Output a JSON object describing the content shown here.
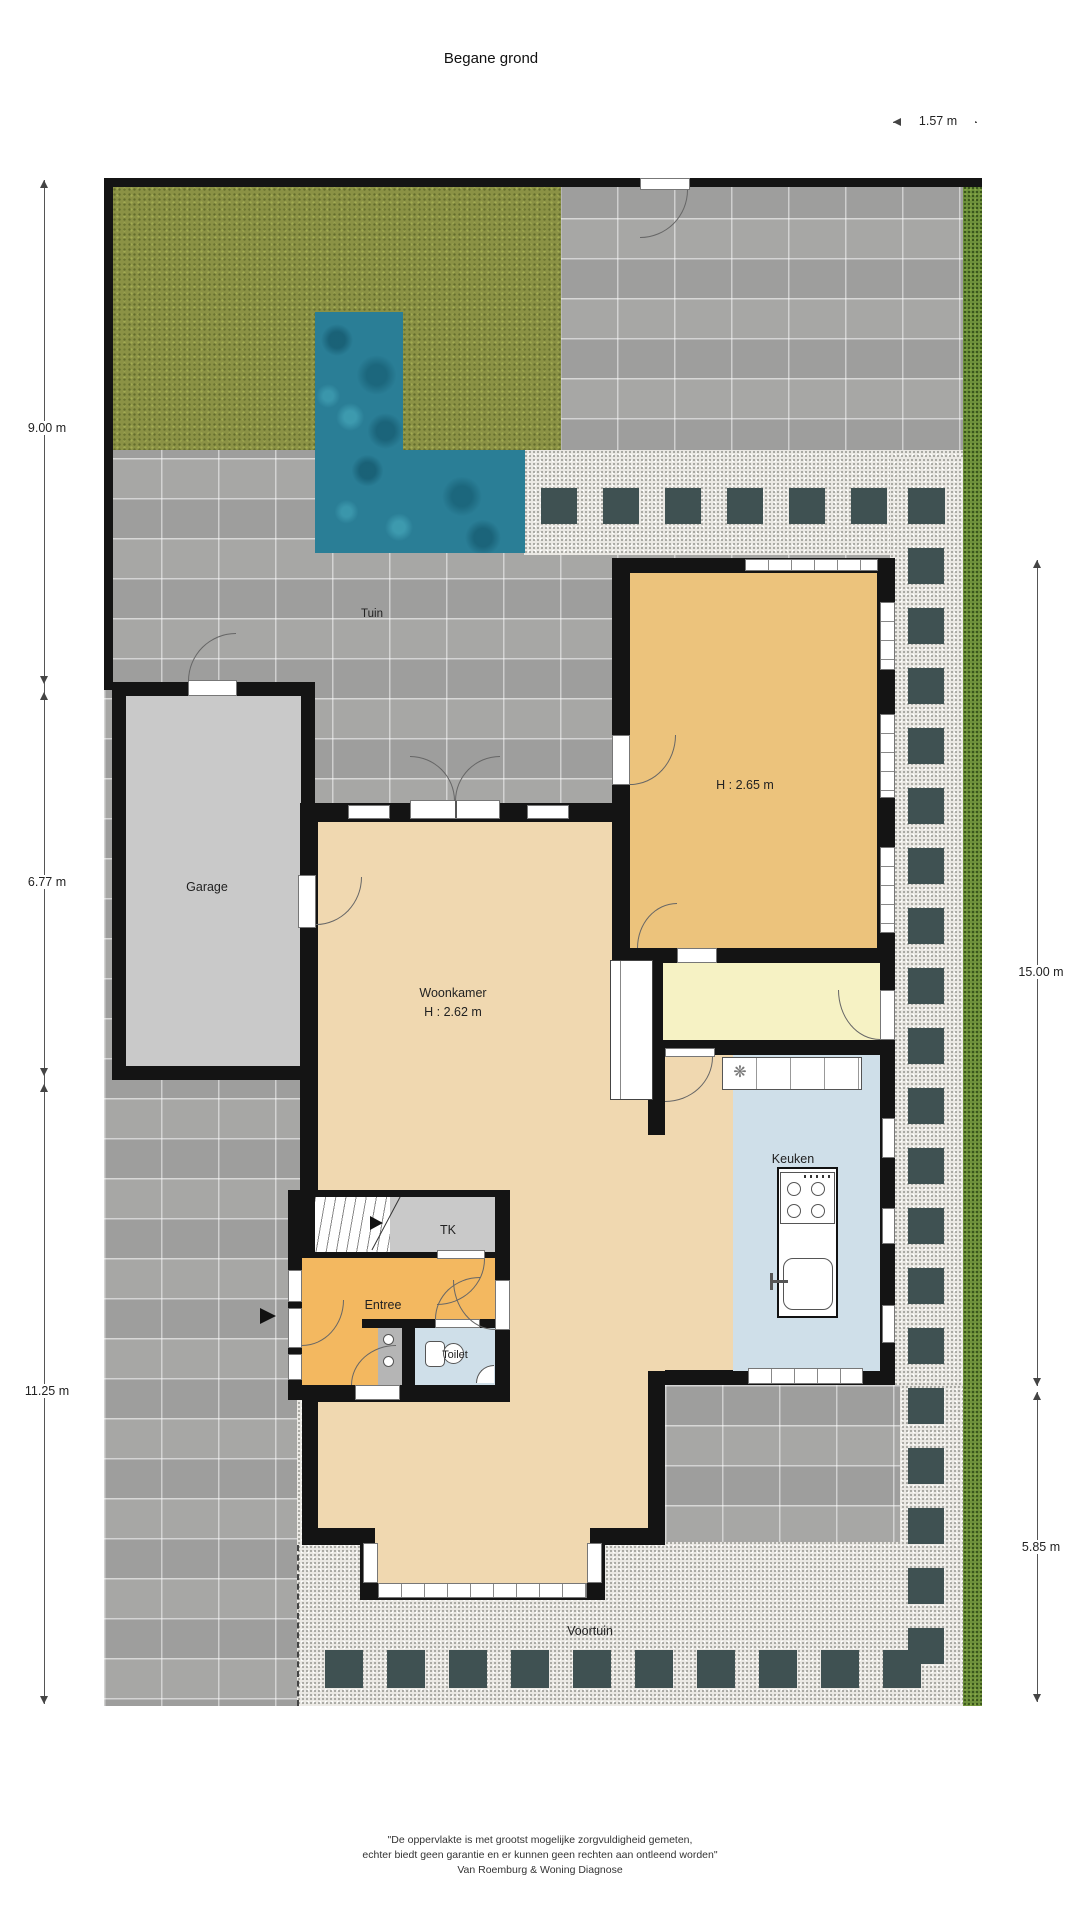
{
  "title": "Begane grond",
  "dimensions": {
    "top_width": "1.57 m",
    "left": [
      {
        "label": "9.00 m"
      },
      {
        "label": "6.77 m"
      },
      {
        "label": "11.25 m"
      }
    ],
    "right": [
      {
        "label": "15.00 m"
      },
      {
        "label": "5.85 m"
      }
    ]
  },
  "rooms": {
    "tuin": "Tuin",
    "garage": "Garage",
    "woonkamer": "Woonkamer",
    "woonkamer_height": "H : 2.62 m",
    "bedroom_height": "H : 2.65 m",
    "keuken": "Keuken",
    "tk": "TK",
    "entree": "Entree",
    "toilet": "Toilet",
    "voortuin": "Voortuin"
  },
  "symbols": {
    "hob_symbol": "❋"
  },
  "footer": {
    "line1": "\"De oppervlakte is met grootst mogelijke zorgvuldigheid gemeten,",
    "line2": "echter biedt geen garantie en er kunnen geen rechten aan ontleend worden\"",
    "line3": "Van Roemburg & Woning Diagnose"
  },
  "colors": {
    "wall": "#141414",
    "living_floor": "#f0d8b0",
    "bedroom_floor": "#ecc37c",
    "pantry_floor": "#f6f2c4",
    "kitchen_floor": "#cfdfe9",
    "entree_floor": "#f3b860",
    "garage_floor": "#c9c9c9",
    "lawn": "#8b9245",
    "pool": "#2a7e96",
    "paving": "#a7a7a5",
    "gravel": "#eceae5",
    "hedge": "#6f923c",
    "garden_tile": "#3f5152"
  }
}
